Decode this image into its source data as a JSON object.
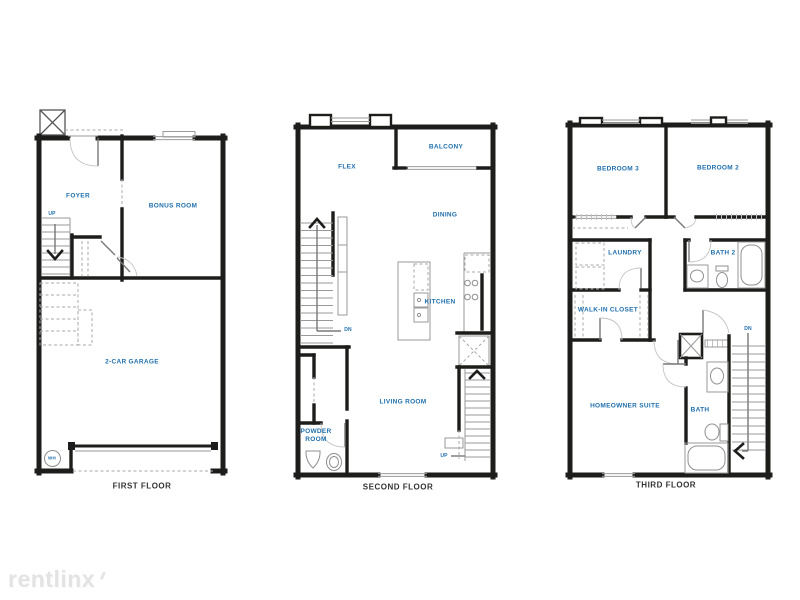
{
  "palette": {
    "accent_blue": "#1f6fad",
    "wall": "#1d1d1b",
    "floor_label": "#333333"
  },
  "watermark": {
    "text": "rentlinx"
  },
  "floors": [
    {
      "name": "FIRST FLOOR",
      "rooms": [
        {
          "label": "FOYER"
        },
        {
          "label": "BONUS ROOM"
        },
        {
          "label": "2-CAR GARAGE"
        }
      ],
      "annotations": [
        {
          "label": "UP"
        },
        {
          "label": "WH"
        }
      ]
    },
    {
      "name": "SECOND FLOOR",
      "rooms": [
        {
          "label": "FLEX"
        },
        {
          "label": "BALCONY"
        },
        {
          "label": "DINING"
        },
        {
          "label": "KITCHEN"
        },
        {
          "label": "LIVING ROOM"
        },
        {
          "label": "POWDER ROOM"
        }
      ],
      "annotations": [
        {
          "label": "DN"
        },
        {
          "label": "UP"
        }
      ]
    },
    {
      "name": "THIRD FLOOR",
      "rooms": [
        {
          "label": "BEDROOM 3"
        },
        {
          "label": "BEDROOM 2"
        },
        {
          "label": "LAUNDRY"
        },
        {
          "label": "BATH 2"
        },
        {
          "label": "WALK-IN CLOSET"
        },
        {
          "label": "HOMEOWNER SUITE"
        },
        {
          "label": "BATH"
        }
      ],
      "annotations": [
        {
          "label": "DN"
        }
      ]
    }
  ]
}
